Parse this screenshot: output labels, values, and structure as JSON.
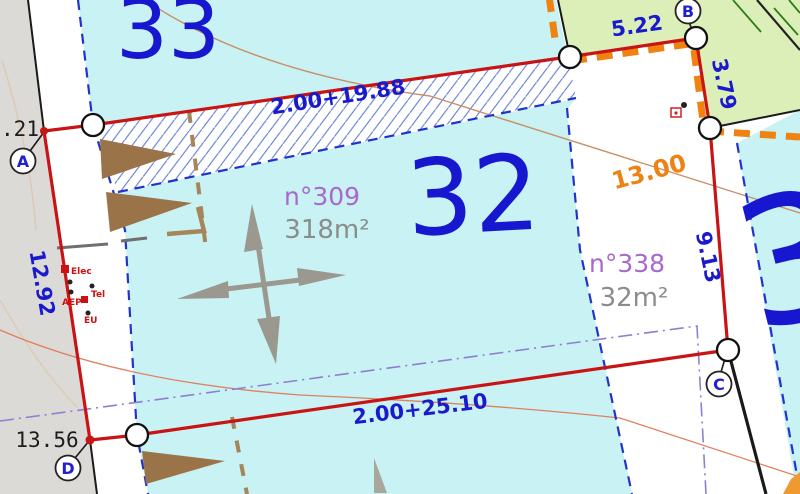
{
  "map": {
    "type": "cadastral-parcel-plan",
    "parcel_numbers": {
      "p33": "33",
      "p32": "32",
      "p3": "3"
    },
    "lots": {
      "lot309": {
        "name": "n°309",
        "area": "318m²"
      },
      "lot338": {
        "name": "n°338",
        "area": "32m²"
      }
    },
    "measurements": {
      "top_side": "2.00+19.88",
      "bottom_side": "2.00+25.10",
      "left_side": "12.92",
      "right_side": "9.13",
      "north_top": "5.22",
      "north_side": "3.79",
      "width_line": "13.00",
      "offset_a": ".21",
      "offset_d": "13.56"
    },
    "vertices": {
      "a": "A",
      "b": "B",
      "c": "C",
      "d": "D"
    },
    "utilities": {
      "elec": "Elec",
      "tel": "Tel",
      "aep": "AEP",
      "eu": "EU"
    },
    "colors": {
      "parcel_cyan": "#c8f2f4",
      "parcel_green": "#ddefb8",
      "road_gray": "#dcdad7",
      "boundary_red": "#c81414",
      "label_blue": "#1a1acc",
      "big_number_blue": "#1717cf",
      "orange_dash": "#ef8211",
      "lot_purple": "#a868cc",
      "area_gray": "#8c8c8c",
      "hatch_blue": "#5c7ad0",
      "dashed_blue": "#2233cc",
      "dashdot_purple": "#8f7fd0",
      "arrow_brown": "#9a7448",
      "arrow_gray": "#9b998f",
      "tan_dash": "#a5855a",
      "curve_salmon": "#e08060",
      "curve_tan": "#c98f66"
    }
  }
}
